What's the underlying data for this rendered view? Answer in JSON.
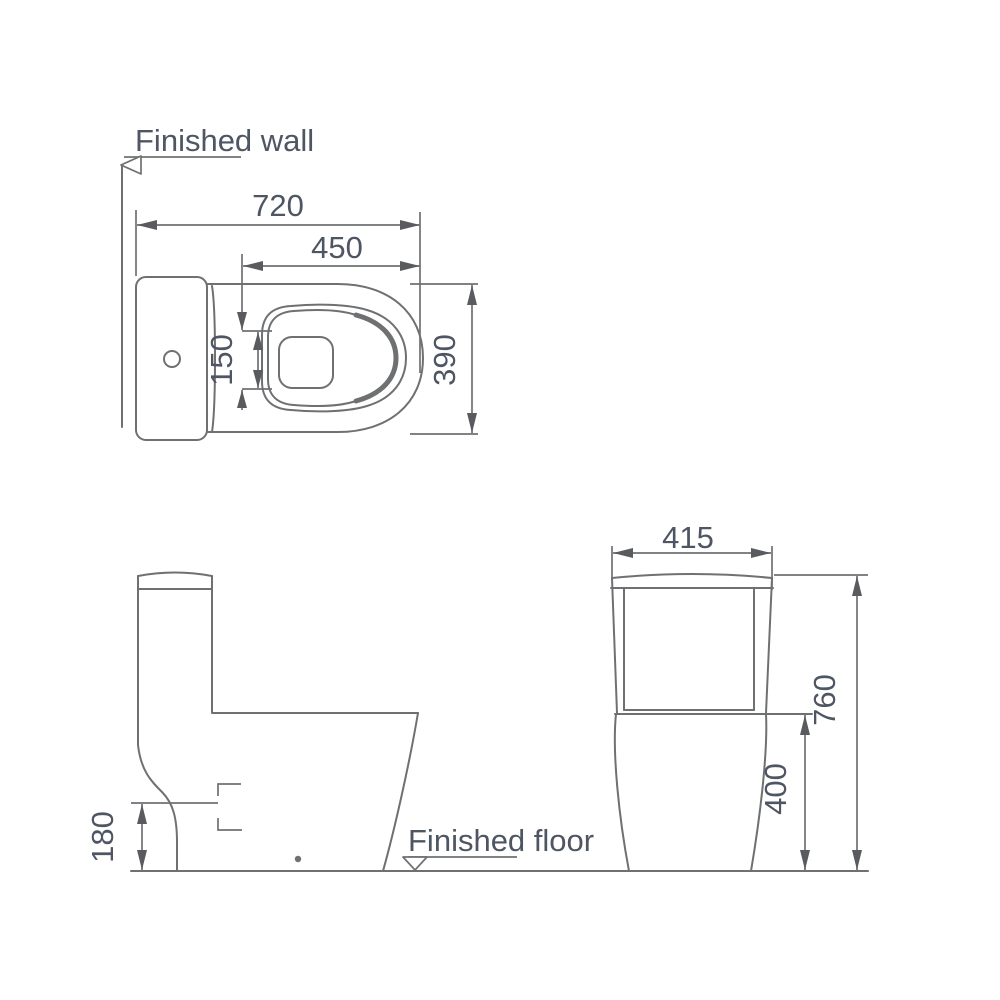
{
  "diagram": {
    "labels": {
      "finished_wall": "Finished wall",
      "finished_floor": "Finished floor"
    },
    "dimensions": {
      "top_view": {
        "overall_depth": "720",
        "seat_length": "450",
        "water_spot_width": "150",
        "bowl_width": "390"
      },
      "front_view": {
        "tank_width": "415",
        "overall_height": "760",
        "rim_height": "400"
      },
      "side_view": {
        "outlet_height": "180"
      }
    },
    "colors": {
      "background": "#ffffff",
      "line": "#6e7072",
      "text": "#4e5663",
      "arrow": "#595b5e"
    }
  }
}
